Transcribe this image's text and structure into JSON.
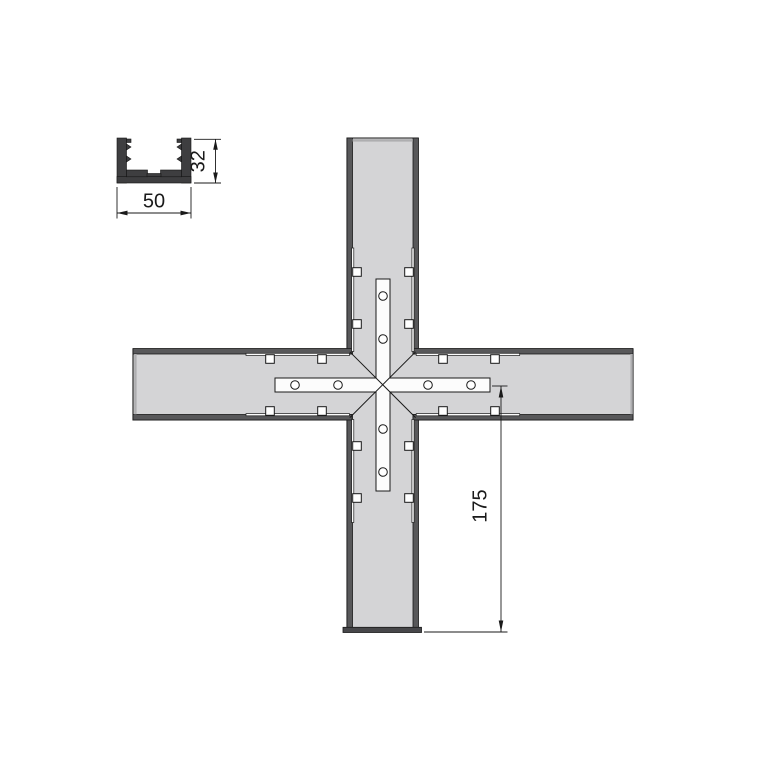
{
  "title": "Cross profile connector technical drawing",
  "colors": {
    "page_bg": "#ffffff",
    "line": "#1a1a1a",
    "profile_fill": "#d4d4d6",
    "profile_wall": "#58585a",
    "profile_end": "#aeaeb0",
    "profile_bottom_end": "#47474a",
    "plate_fill": "#fcfcfc",
    "section_fill": "#3e3e40"
  },
  "labels": {
    "section_width": "50",
    "section_height": "32",
    "arm_length": "175"
  }
}
